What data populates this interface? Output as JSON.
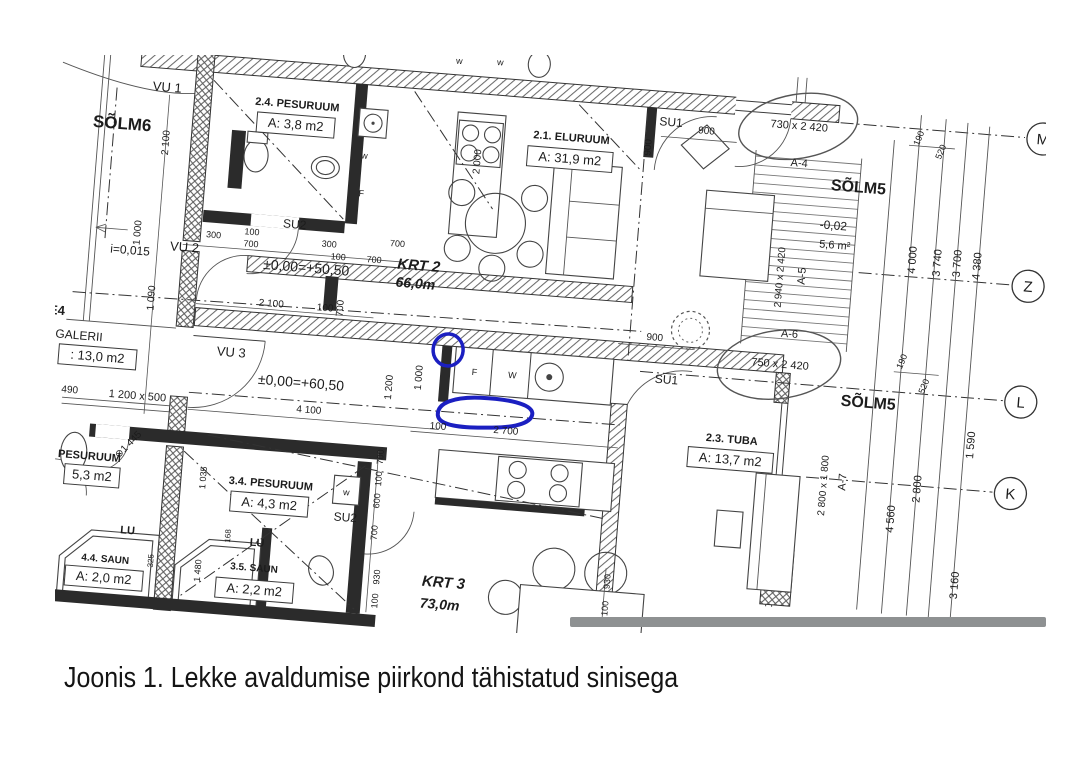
{
  "figure": {
    "caption": "Joonis 1. Lekke avaldumise piirkond tähistatud sinisega"
  },
  "colors": {
    "annotation_blue": "#1b1fc1",
    "separator_gray": "#8e9192",
    "ink": "#2b2b2b"
  },
  "plan": {
    "grid_bubbles": [
      {
        "id": "grid-M",
        "text": "M",
        "x": 1045,
        "y": 72
      },
      {
        "id": "grid-Z",
        "text": "Z",
        "x": 1042,
        "y": 220
      },
      {
        "id": "grid-L",
        "text": "L",
        "x": 1044,
        "y": 336
      },
      {
        "id": "grid-K",
        "text": "K",
        "x": 1041,
        "y": 428
      }
    ],
    "labels": [
      {
        "id": "solm6",
        "text": "SÕLM6",
        "x": 126,
        "y": 136,
        "size": 17,
        "bold": 1
      },
      {
        "id": "vu1",
        "text": "VU 1",
        "x": 168,
        "y": 95,
        "size": 13
      },
      {
        "id": "dim-2100-left",
        "text": "2 100",
        "x": 174,
        "y": 146,
        "size": 10,
        "rot": -90
      },
      {
        "id": "dim-1000-left",
        "text": "1 000",
        "x": 153,
        "y": 238,
        "size": 10,
        "rot": -90
      },
      {
        "id": "slope",
        "text": "i=0,015",
        "x": 144,
        "y": 260,
        "size": 12
      },
      {
        "id": "vu2",
        "text": "VU 2",
        "x": 198,
        "y": 253,
        "size": 13
      },
      {
        "id": "dim-1090-left",
        "text": "1 090",
        "x": 172,
        "y": 302,
        "size": 10,
        "rot": -90
      },
      {
        "id": "room-24",
        "text": "2.4. PESURUUM",
        "x": 299,
        "y": 101,
        "size": 11,
        "bold": 1
      },
      {
        "id": "room-24-area",
        "text": "A: 3,8 m2",
        "x": 299,
        "y": 122,
        "size": 13,
        "boxed": 1
      },
      {
        "id": "dim-300-a",
        "text": "300",
        "x": 226,
        "y": 237,
        "size": 9
      },
      {
        "id": "dim-100-a",
        "text": "100",
        "x": 264,
        "y": 231,
        "size": 9
      },
      {
        "id": "dim-700-a",
        "text": "700",
        "x": 264,
        "y": 243,
        "size": 9
      },
      {
        "id": "su2-top",
        "text": "SU2",
        "x": 306,
        "y": 221,
        "size": 12
      },
      {
        "id": "dim-300-b",
        "text": "300",
        "x": 342,
        "y": 237,
        "size": 9
      },
      {
        "id": "dim-100-b",
        "text": "100",
        "x": 352,
        "y": 249,
        "size": 9
      },
      {
        "id": "dim-700-b",
        "text": "700",
        "x": 388,
        "y": 249,
        "size": 9
      },
      {
        "id": "dim-700-c",
        "text": "700",
        "x": 410,
        "y": 231,
        "size": 9
      },
      {
        "id": "level-krt2",
        "text": "±0,00=+50,50",
        "x": 321,
        "y": 264,
        "size": 14
      },
      {
        "id": "krt2",
        "text": "KRT 2",
        "x": 433,
        "y": 253,
        "size": 15,
        "bold": 1,
        "italic": 1
      },
      {
        "id": "krt2-area",
        "text": "66,0m",
        "x": 431,
        "y": 271,
        "size": 14,
        "bold": 1,
        "italic": 1
      },
      {
        "id": "dim-2000-v",
        "text": "2 000",
        "x": 486,
        "y": 140,
        "size": 10,
        "rot": -90
      },
      {
        "id": "appl-w-kitchen",
        "text": "w",
        "x": 370,
        "y": 146,
        "size": 9
      },
      {
        "id": "appl-f-kitchen",
        "text": "F",
        "x": 370,
        "y": 184,
        "size": 9
      },
      {
        "id": "room-21",
        "text": "2.1. ELURUUM",
        "x": 575,
        "y": 112,
        "size": 11,
        "bold": 1
      },
      {
        "id": "room-21-area",
        "text": "A: 31,9 m2",
        "x": 575,
        "y": 134,
        "size": 13,
        "boxed": 1
      },
      {
        "id": "dim-900-v",
        "text": "900",
        "x": 655,
        "y": 112,
        "size": 10,
        "rot": -90
      },
      {
        "id": "su1-top",
        "text": "SU1",
        "x": 673,
        "y": 89,
        "size": 12
      },
      {
        "id": "dim-900-top",
        "text": "900",
        "x": 709,
        "y": 94,
        "size": 10
      },
      {
        "id": "door-730",
        "text": "730 x 2 420",
        "x": 801,
        "y": 82,
        "size": 11
      },
      {
        "id": "a4",
        "text": "A-4",
        "x": 804,
        "y": 119,
        "size": 11
      },
      {
        "id": "solm5-top",
        "text": "SÕLM5",
        "x": 865,
        "y": 140,
        "size": 16,
        "bold": 1
      },
      {
        "id": "level-stairs",
        "text": "-0,02",
        "x": 843,
        "y": 179,
        "size": 12
      },
      {
        "id": "stairs-area",
        "text": "5,6 m²",
        "x": 846,
        "y": 198,
        "size": 11
      },
      {
        "id": "door-2940",
        "text": "2 940 x 2 420",
        "x": 797,
        "y": 231,
        "size": 10,
        "rot": -90
      },
      {
        "id": "a5",
        "text": "A-5",
        "x": 819,
        "y": 228,
        "size": 11,
        "rot": -90
      },
      {
        "id": "a6",
        "text": "A-6",
        "x": 808,
        "y": 290,
        "size": 11
      },
      {
        "id": "door-750",
        "text": "750 x 2 420",
        "x": 801,
        "y": 321,
        "size": 11
      },
      {
        "id": "solm5-mid",
        "text": "SÕLM5",
        "x": 892,
        "y": 354,
        "size": 16,
        "bold": 1
      },
      {
        "id": "dim-190-top",
        "text": "190",
        "x": 924,
        "y": 82,
        "size": 9,
        "rot": -72
      },
      {
        "id": "dim-520-top",
        "text": "520",
        "x": 947,
        "y": 94,
        "size": 9,
        "rot": -72
      },
      {
        "id": "grid-dim-4000",
        "text": "4 000",
        "x": 928,
        "y": 203,
        "size": 11,
        "rot": -90
      },
      {
        "id": "grid-dim-3740",
        "text": "3 740",
        "x": 953,
        "y": 204,
        "size": 11,
        "rot": -90
      },
      {
        "id": "grid-dim-3700",
        "text": "3 700",
        "x": 973,
        "y": 203,
        "size": 11,
        "rot": -90
      },
      {
        "id": "grid-dim-4380",
        "text": "4 380",
        "x": 993,
        "y": 204,
        "size": 11,
        "rot": -90
      },
      {
        "id": "vu3",
        "text": "VU 3",
        "x": 253,
        "y": 354,
        "size": 13
      },
      {
        "id": "level-krt3",
        "text": "±0,00=+60,50",
        "x": 325,
        "y": 379,
        "size": 14
      },
      {
        "id": "dim-4100",
        "text": "4 100",
        "x": 335,
        "y": 404,
        "size": 10
      },
      {
        "id": "dim-2100-mid",
        "text": "2 100",
        "x": 289,
        "y": 301,
        "size": 10
      },
      {
        "id": "dim-100-mid",
        "text": "100",
        "x": 343,
        "y": 301,
        "size": 10
      },
      {
        "id": "dim-700-mid",
        "text": "700",
        "x": 361,
        "y": 297,
        "size": 10,
        "rot": -90
      },
      {
        "id": "dim-1200-v",
        "text": "1 200",
        "x": 416,
        "y": 372,
        "size": 10,
        "rot": -90
      },
      {
        "id": "dim-1000-v",
        "text": "1 000",
        "x": 445,
        "y": 360,
        "size": 10,
        "rot": -90
      },
      {
        "id": "counter-f",
        "text": "F",
        "x": 497,
        "y": 353,
        "size": 9
      },
      {
        "id": "counter-w",
        "text": "W",
        "x": 535,
        "y": 353,
        "size": 9
      },
      {
        "id": "dim-100-c",
        "text": "100",
        "x": 465,
        "y": 410,
        "size": 10
      },
      {
        "id": "dim-2700",
        "text": "2 700",
        "x": 533,
        "y": 409,
        "size": 10
      },
      {
        "id": "dim-900-mid",
        "text": "900",
        "x": 674,
        "y": 304,
        "size": 10
      },
      {
        "id": "su1-mid",
        "text": "SU1",
        "x": 689,
        "y": 346,
        "size": 12
      },
      {
        "id": "room-23",
        "text": "2.3. TUBA",
        "x": 759,
        "y": 400,
        "size": 11,
        "bold": 1
      },
      {
        "id": "room-23-area",
        "text": "A: 13,7 m2",
        "x": 759,
        "y": 421,
        "size": 13,
        "boxed": 1
      },
      {
        "id": "door-2800",
        "text": "2 800 x 1 800",
        "x": 857,
        "y": 435,
        "size": 10,
        "rot": -90
      },
      {
        "id": "a7",
        "text": "A-7",
        "x": 876,
        "y": 430,
        "size": 11,
        "rot": -90
      },
      {
        "id": "dim-190-mid",
        "text": "190",
        "x": 925,
        "y": 306,
        "size": 9,
        "rot": -72
      },
      {
        "id": "dim-520-mid",
        "text": "520",
        "x": 949,
        "y": 329,
        "size": 9,
        "rot": -72
      },
      {
        "id": "grid-dim-1590",
        "text": "1 590",
        "x": 1001,
        "y": 383,
        "size": 11,
        "rot": -90
      },
      {
        "id": "grid-dim-2800",
        "text": "2 800",
        "x": 951,
        "y": 431,
        "size": 11,
        "rot": -90
      },
      {
        "id": "grid-dim-4560",
        "text": "4 560",
        "x": 927,
        "y": 463,
        "size": 11,
        "rot": -90
      },
      {
        "id": "grid-dim-3160",
        "text": "3 160",
        "x": 996,
        "y": 524,
        "size": 11,
        "rot": -90
      },
      {
        "id": "sect-e4",
        "text": "E4",
        "x": 76,
        "y": 326,
        "size": 13,
        "bold": 1
      },
      {
        "id": "galerii",
        "text": "GALERII",
        "x": 100,
        "y": 349,
        "size": 12
      },
      {
        "id": "galerii-area",
        "text": ": 13,0 m2",
        "x": 120,
        "y": 369,
        "size": 13,
        "boxed": 1
      },
      {
        "id": "dim-490",
        "text": "490",
        "x": 95,
        "y": 403,
        "size": 10
      },
      {
        "id": "window-1200x500",
        "text": "1 200 x 500",
        "x": 163,
        "y": 404,
        "size": 11
      },
      {
        "id": "room-pes53",
        "text": "PESURUUM",
        "x": 120,
        "y": 468,
        "size": 11,
        "bold": 1
      },
      {
        "id": "room-pes53-area",
        "text": "5,3 m2",
        "x": 124,
        "y": 488,
        "size": 13,
        "boxed": 1
      },
      {
        "id": "dim-1445",
        "text": "⊗1 445",
        "x": 160,
        "y": 452,
        "size": 10,
        "rot": -50
      },
      {
        "id": "dim-1035",
        "text": "1 035",
        "x": 238,
        "y": 477,
        "size": 9,
        "rot": -90
      },
      {
        "id": "room-34",
        "text": "3.4. PESURUUM",
        "x": 303,
        "y": 481,
        "size": 11,
        "bold": 1
      },
      {
        "id": "room-34-area",
        "text": "A: 4,3 m2",
        "x": 303,
        "y": 502,
        "size": 13,
        "boxed": 1
      },
      {
        "id": "appl-w-su2",
        "text": "w",
        "x": 379,
        "y": 483,
        "size": 9
      },
      {
        "id": "su2-bottom",
        "text": "SU2",
        "x": 380,
        "y": 509,
        "size": 12
      },
      {
        "id": "lu-1",
        "text": "LU",
        "x": 164,
        "y": 539,
        "size": 11,
        "bold": 1
      },
      {
        "id": "lu-2",
        "text": "LU",
        "x": 294,
        "y": 541,
        "size": 11,
        "bold": 1
      },
      {
        "id": "dim-1480",
        "text": "1 480",
        "x": 240,
        "y": 570,
        "size": 9,
        "rot": -90
      },
      {
        "id": "dim-168",
        "text": "168",
        "x": 267,
        "y": 533,
        "size": 8,
        "rot": -90
      },
      {
        "id": "dim-325",
        "text": "325",
        "x": 192,
        "y": 564,
        "size": 8,
        "rot": -90
      },
      {
        "id": "room-44",
        "text": "4.4. SAUN",
        "x": 144,
        "y": 569,
        "size": 10,
        "bold": 1
      },
      {
        "id": "room-44-area",
        "text": "A: 2,0 m2",
        "x": 144,
        "y": 589,
        "size": 13,
        "boxed": 1
      },
      {
        "id": "room-35",
        "text": "3.5. SAUN",
        "x": 293,
        "y": 566,
        "size": 10,
        "bold": 1
      },
      {
        "id": "room-35-area",
        "text": "A: 2,2 m2",
        "x": 295,
        "y": 589,
        "size": 13,
        "boxed": 1
      },
      {
        "id": "krt3",
        "text": "KRT 3",
        "x": 483,
        "y": 567,
        "size": 15,
        "bold": 1,
        "italic": 1
      },
      {
        "id": "krt3-area",
        "text": "73,0m",
        "x": 481,
        "y": 589,
        "size": 14,
        "bold": 1,
        "italic": 1
      },
      {
        "id": "dim-700-d",
        "text": "700",
        "x": 413,
        "y": 442,
        "size": 9,
        "rot": -90
      },
      {
        "id": "dim-100-d",
        "text": "100",
        "x": 413,
        "y": 464,
        "size": 9,
        "rot": -90
      },
      {
        "id": "dim-600",
        "text": "600",
        "x": 413,
        "y": 486,
        "size": 9,
        "rot": -90
      },
      {
        "id": "dim-700-e",
        "text": "700",
        "x": 413,
        "y": 518,
        "size": 9,
        "rot": -90
      },
      {
        "id": "dim-930-a",
        "text": "930",
        "x": 419,
        "y": 562,
        "size": 9,
        "rot": -90
      },
      {
        "id": "dim-100-e",
        "text": "100",
        "x": 419,
        "y": 586,
        "size": 9,
        "rot": -90
      },
      {
        "id": "dim-930-b",
        "text": "930",
        "x": 649,
        "y": 548,
        "size": 9,
        "rot": -90
      },
      {
        "id": "dim-100-f",
        "text": "100",
        "x": 649,
        "y": 575,
        "size": 9,
        "rot": -90
      },
      {
        "id": "fixt-w-top1",
        "text": "w",
        "x": 457,
        "y": 44,
        "size": 9
      },
      {
        "id": "fixt-w-top2",
        "text": "w",
        "x": 498,
        "y": 42,
        "size": 9
      }
    ]
  }
}
